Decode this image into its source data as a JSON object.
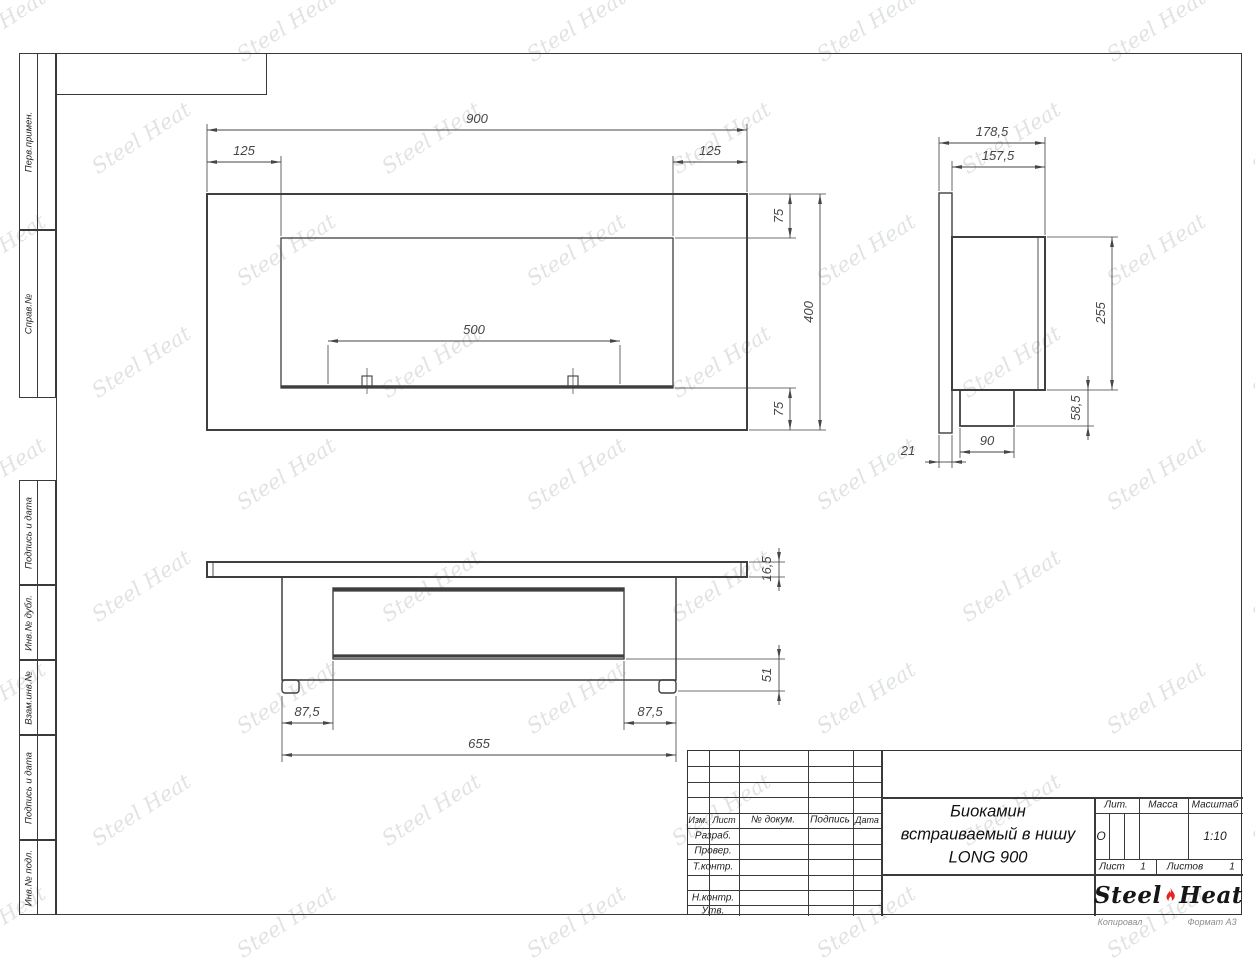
{
  "watermark": {
    "text": "Steel Heat",
    "color": "rgba(152,166,152,0.30)"
  },
  "margin_columns": {
    "cells": [
      {
        "label": "Перв.примен.",
        "top": 53,
        "height": 177
      },
      {
        "label": "Справ.№",
        "top": 230,
        "height": 168
      },
      {
        "label": "Подпись и дата",
        "top": 480,
        "height": 105
      },
      {
        "label": "Инв.№ дубл.",
        "top": 585,
        "height": 75
      },
      {
        "label": "Взам.инв.№",
        "top": 660,
        "height": 75
      },
      {
        "label": "Подпись и дата",
        "top": 735,
        "height": 105
      },
      {
        "label": "Инв.№ подл.",
        "top": 840,
        "height": 75
      }
    ]
  },
  "drawing": {
    "line_color": "#3f3f3f",
    "dim_color": "#464646",
    "views": [
      {
        "name": "front-view",
        "rects": [
          [
            207,
            194,
            540,
            236,
            2
          ],
          [
            281,
            238,
            392,
            150,
            1.3
          ],
          [
            362,
            376,
            10,
            10,
            1.1
          ],
          [
            568,
            376,
            10,
            10,
            1.1
          ]
        ],
        "lines": [
          [
            281,
            386.5,
            673,
            386.5,
            2.6
          ],
          [
            367,
            368,
            367,
            394,
            0.7
          ],
          [
            573,
            368,
            573,
            394,
            0.7
          ],
          [
            207,
            124,
            207,
            192,
            0.8
          ],
          [
            747,
            124,
            747,
            192,
            0.8
          ],
          [
            281,
            156,
            281,
            236,
            0.8
          ],
          [
            673,
            156,
            673,
            236,
            0.8
          ],
          [
            749,
            194,
            826,
            194,
            0.8
          ],
          [
            675,
            238,
            796,
            238,
            0.8
          ],
          [
            675,
            388,
            796,
            388,
            0.8
          ],
          [
            749,
            430,
            826,
            430,
            0.8
          ],
          [
            328,
            345,
            328,
            384,
            0.8
          ],
          [
            620,
            345,
            620,
            384,
            0.8
          ]
        ],
        "dims": [
          {
            "t": "900",
            "line": [
              207,
              130,
              747,
              130
            ],
            "lx": 477,
            "ly": 123
          },
          {
            "t": "125",
            "line": [
              207,
              162,
              281,
              162
            ],
            "lx": 244,
            "ly": 155
          },
          {
            "t": "125",
            "line": [
              673,
              162,
              747,
              162
            ],
            "lx": 710,
            "ly": 155
          },
          {
            "t": "75",
            "line": [
              790,
              194,
              790,
              238
            ],
            "lx": 783,
            "ly": 216,
            "rot": -90
          },
          {
            "t": "400",
            "line": [
              820,
              194,
              820,
              430
            ],
            "lx": 813,
            "ly": 312,
            "rot": -90
          },
          {
            "t": "75",
            "line": [
              790,
              388,
              790,
              430
            ],
            "lx": 783,
            "ly": 409,
            "rot": -90
          },
          {
            "t": "500",
            "line": [
              328,
              341,
              620,
              341
            ],
            "lx": 474,
            "ly": 334
          }
        ]
      },
      {
        "name": "side-view",
        "rects": [
          [
            939,
            193,
            13,
            240,
            1.4
          ],
          [
            952,
            237,
            93,
            153,
            2
          ],
          [
            960,
            390,
            54,
            36,
            1.8
          ]
        ],
        "lines": [
          [
            1038,
            237,
            1038,
            390,
            0.9
          ],
          [
            939,
            137,
            939,
            191,
            0.8
          ],
          [
            1045,
            137,
            1045,
            235,
            0.8
          ],
          [
            952,
            161,
            952,
            191,
            0.8
          ],
          [
            1047,
            237,
            1118,
            237,
            0.8
          ],
          [
            1047,
            390,
            1118,
            390,
            0.8
          ],
          [
            1016,
            426,
            1094,
            426,
            0.8
          ],
          [
            960,
            428,
            960,
            458,
            0.8
          ],
          [
            1014,
            428,
            1014,
            458,
            0.8
          ],
          [
            939,
            435,
            939,
            468,
            0.8
          ],
          [
            952,
            435,
            952,
            468,
            0.8
          ]
        ],
        "dims": [
          {
            "t": "178,5",
            "line": [
              939,
              143,
              1045,
              143
            ],
            "lx": 992,
            "ly": 136
          },
          {
            "t": "157,5",
            "line": [
              952,
              167,
              1045,
              167
            ],
            "lx": 998,
            "ly": 160
          },
          {
            "t": "255",
            "line": [
              1112,
              237,
              1112,
              390
            ],
            "lx": 1105,
            "ly": 313,
            "rot": -90
          },
          {
            "t": "58,5",
            "line": [
              1088,
              390,
              1088,
              426
            ],
            "lx": 1080,
            "ly": 408,
            "rot": -90,
            "out": true
          },
          {
            "t": "90",
            "line": [
              960,
              452,
              1014,
              452
            ],
            "lx": 987,
            "ly": 445
          },
          {
            "t": "21",
            "line": [
              939,
              462,
              952,
              462
            ],
            "lx": 908,
            "ly": 455,
            "out": true
          }
        ]
      },
      {
        "name": "bottom-view",
        "rects": [
          [
            207,
            562,
            540,
            15,
            2
          ],
          [
            282,
            577,
            394,
            103,
            1.5
          ],
          [
            333,
            588,
            291,
            71,
            1.4
          ],
          [
            282,
            680,
            17,
            13,
            1.4,
            3
          ],
          [
            659,
            680,
            17,
            13,
            1.4,
            3
          ]
        ],
        "lines": [
          [
            333,
            590,
            624,
            590,
            3.2
          ],
          [
            333,
            656,
            624,
            656,
            3.2
          ],
          [
            213,
            562,
            213,
            577,
            0.9
          ],
          [
            741,
            562,
            741,
            577,
            0.9
          ],
          [
            749,
            562,
            785,
            562,
            0.8
          ],
          [
            749,
            577,
            785,
            577,
            0.8
          ],
          [
            626,
            659,
            785,
            659,
            0.8
          ],
          [
            678,
            691,
            785,
            691,
            0.8
          ],
          [
            282,
            696,
            282,
            762,
            0.8
          ],
          [
            333,
            661,
            333,
            730,
            0.8
          ],
          [
            624,
            661,
            624,
            730,
            0.8
          ],
          [
            676,
            696,
            676,
            762,
            0.8
          ]
        ],
        "dims": [
          {
            "t": "16,5",
            "line": [
              779,
              562,
              779,
              577
            ],
            "lx": 771,
            "ly": 569,
            "rot": -90,
            "out": true
          },
          {
            "t": "51",
            "line": [
              779,
              659,
              779,
              691
            ],
            "lx": 771,
            "ly": 675,
            "rot": -90,
            "out": true
          },
          {
            "t": "87,5",
            "line": [
              282,
              723,
              333,
              723
            ],
            "lx": 307,
            "ly": 716
          },
          {
            "t": "87,5",
            "line": [
              624,
              723,
              676,
              723
            ],
            "lx": 650,
            "ly": 716
          },
          {
            "t": "655",
            "line": [
              282,
              755,
              676,
              755
            ],
            "lx": 479,
            "ly": 748
          }
        ]
      }
    ]
  },
  "title_block": {
    "rev_header": {
      "izm": "Изм.",
      "list": "Лист",
      "doc": "№ докум.",
      "sign": "Подпись",
      "date": "Дата"
    },
    "row_labels": {
      "razrab": "Разраб.",
      "prover": "Провер.",
      "tkontr": "Т.контр.",
      "nkontr": "Н.контр.",
      "utv": "Утв."
    },
    "title_lines": {
      "l1": "Биокамин",
      "l2": "встраиваемый в нишу",
      "l3": "LONG 900"
    },
    "lit_header": "Лит.",
    "mass_header": "Масса",
    "scale_header": "Масштаб",
    "lit_value": "О",
    "scale_value": "1:10",
    "sheet_label": "Лист",
    "sheet_value": "1",
    "sheets_label": "Листов",
    "sheets_value": "1",
    "logo": {
      "steel": "Steel",
      "heat": "Heat",
      "flame_color": "#e62420"
    }
  },
  "footer": {
    "copied": "Копировал",
    "format": "Формат А3"
  }
}
